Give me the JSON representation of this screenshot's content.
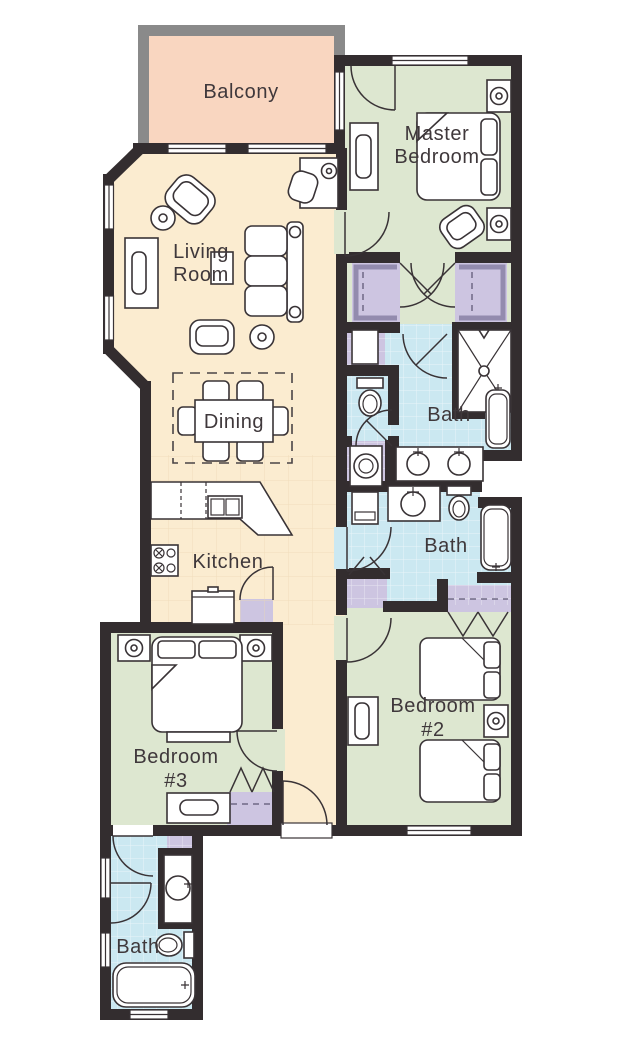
{
  "plan": {
    "colors": {
      "wall": "#332d2f",
      "balcony_wall": "#8a8a8a",
      "living": "#fbecd0",
      "bedroom": "#dde7d0",
      "bath": "#cbe8f1",
      "closet": "#cdc5e1",
      "balcony": "#f9d6c0",
      "label": "#3f383b",
      "white": "#ffffff"
    },
    "rooms": {
      "balcony": {
        "label": "Balcony"
      },
      "master_bedroom": {
        "line1": "Master",
        "line2": "Bedroom"
      },
      "living_room": {
        "line1": "Living",
        "line2": "Room"
      },
      "dining": {
        "label": "Dining"
      },
      "kitchen": {
        "label": "Kitchen"
      },
      "master_bath": {
        "label": "Bath"
      },
      "second_bath": {
        "label": "Bath"
      },
      "bedroom_2": {
        "line1": "Bedroom",
        "line2": "#2"
      },
      "bedroom_3": {
        "line1": "Bedroom",
        "line2": "#3"
      },
      "third_bath": {
        "label": "Bath"
      }
    }
  }
}
